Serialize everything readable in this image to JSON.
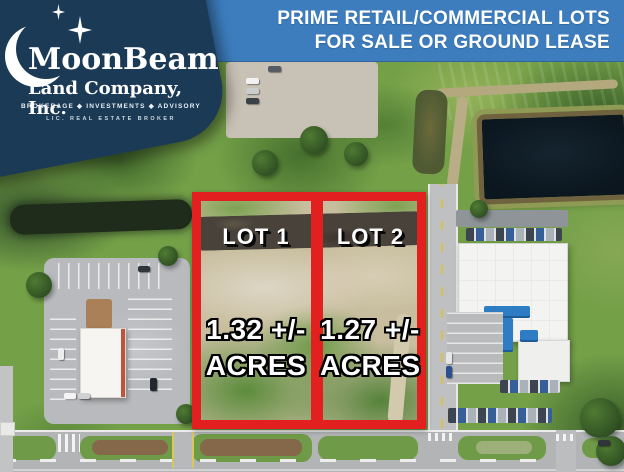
{
  "logo": {
    "company": "MoonBeam",
    "suffix": "Land Company, Inc.",
    "tagline": "BROKERAGE ◆ INVESTMENTS ◆ ADVISORY",
    "license": "LIC. REAL ESTATE BROKER"
  },
  "banner": {
    "line1": "PRIME RETAIL/COMMERCIAL LOTS",
    "line2": "FOR SALE OR GROUND LEASE"
  },
  "lots": [
    {
      "label": "LOT 1",
      "size": "1.32 +/-",
      "unit": "ACRES"
    },
    {
      "label": "LOT 2",
      "size": "1.27 +/-",
      "unit": "ACRES"
    }
  ],
  "colors": {
    "brand_navy": "#1b3a56",
    "banner_blue": "#3d7dbe",
    "highlight_red": "#e2201f"
  }
}
